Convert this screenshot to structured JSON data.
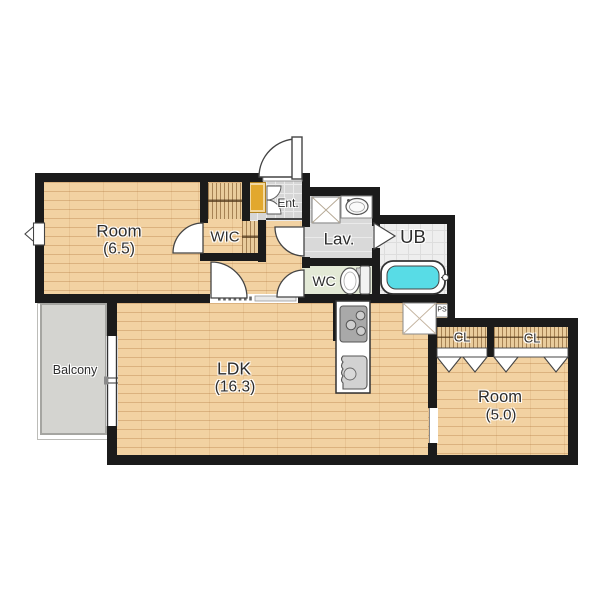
{
  "plan": {
    "type": "apartment-floor-plan",
    "rooms": {
      "room1": {
        "name": "Room",
        "size": "(6.5)"
      },
      "wic": {
        "label": "WIC"
      },
      "ent": {
        "label": "Ent."
      },
      "lav": {
        "label": "Lav."
      },
      "ub": {
        "label": "UB"
      },
      "wc": {
        "label": "WC"
      },
      "ldk": {
        "name": "LDK",
        "size": "(16.3)"
      },
      "balcony": {
        "label": "Balcony"
      },
      "cl1": {
        "label": "CL"
      },
      "cl2": {
        "label": "CL"
      },
      "room2": {
        "name": "Room",
        "size": "(5.0)"
      },
      "ps": {
        "label": "PS"
      }
    },
    "colors": {
      "wall": "#1b1b1b",
      "wood_floor": "#f2d2a2",
      "entrance_tile": "#d6d6d6",
      "lavatory_floor": "#d9d9d9",
      "bathroom_floor": "#eeeeee",
      "wc_floor": "#e3e9d6",
      "balcony_floor": "#d4d4d0",
      "bathtub": "#58dce6",
      "shoe_cabinet": "#e2a82d",
      "label_text": "#2d2d2d"
    },
    "fixtures": {
      "bathtub": "bathtub-icon",
      "toilet": "toilet-icon",
      "wash_basin": "wash-basin-icon",
      "gas_stove": "stove-icon",
      "kitchen_sink": "kitchen-sink-icon",
      "washer_pan": "washing-machine-pan-icon",
      "fridge_space": "refrigerator-space-icon",
      "shoe_cabinet": "shoe-cabinet-icon",
      "door_swing": "door-arc-icon",
      "closet_door": "folding-door-icon",
      "window": "window-icon"
    }
  }
}
